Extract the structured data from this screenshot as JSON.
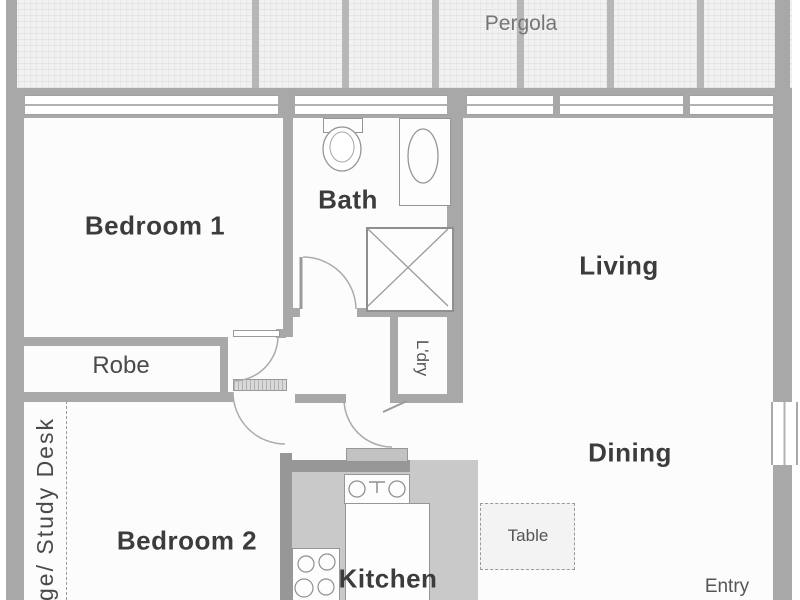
{
  "plan_title": "Apartment floor plan",
  "rooms": {
    "pergola": {
      "label": "Pergola"
    },
    "bedroom1": {
      "label": "Bedroom 1"
    },
    "bath": {
      "label": "Bath"
    },
    "living": {
      "label": "Living"
    },
    "robe": {
      "label": "Robe"
    },
    "laundry": {
      "label": "L'dry"
    },
    "dining": {
      "label": "Dining"
    },
    "bedroom2": {
      "label": "Bedroom 2"
    },
    "kitchen": {
      "label": "Kitchen"
    },
    "entry": {
      "label": "Entry"
    }
  },
  "furniture": {
    "table": {
      "label": "Table"
    },
    "study_nook": {
      "label": "ge/ Study Desk"
    }
  },
  "fixtures": [
    "toilet",
    "basin",
    "shower",
    "kitchen-sink",
    "cooktop",
    "island-bench",
    "fridge-space"
  ],
  "colors": {
    "wall": "#a8a8a8",
    "bench": "#c9c9c9",
    "floor": "#fcfcfc",
    "label_dark": "#3c3c3c",
    "label_gray": "#757575"
  }
}
